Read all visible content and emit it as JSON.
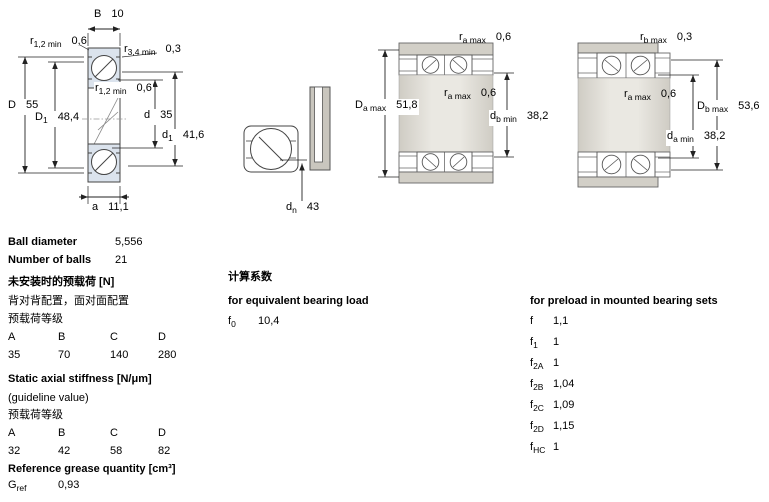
{
  "drawings": {
    "d1": {
      "B": {
        "sym": "B",
        "sub": "",
        "val": "10"
      },
      "r12_top": {
        "sym": "r",
        "sub": "1,2 min",
        "val": "0,6"
      },
      "r34_top": {
        "sym": "r",
        "sub": "3,4 min",
        "val": "0,3"
      },
      "D": {
        "sym": "D",
        "sub": "",
        "val": "55"
      },
      "D1": {
        "sym": "D",
        "sub": "1",
        "val": "48,4"
      },
      "r12_mid": {
        "sym": "r",
        "sub": "1,2 min",
        "val": "0,6"
      },
      "d": {
        "sym": "d",
        "sub": "",
        "val": "35"
      },
      "d1": {
        "sym": "d",
        "sub": "1",
        "val": "41,6"
      },
      "a": {
        "sym": "a",
        "sub": "",
        "val": "11,1"
      }
    },
    "d2": {
      "dn": {
        "sym": "d",
        "sub": "n",
        "val": "43"
      }
    },
    "d3": {
      "ra_top": {
        "sym": "r",
        "sub": "a max",
        "val": "0,6"
      },
      "Da": {
        "sym": "D",
        "sub": "a max",
        "val": "51,8"
      },
      "ra_mid": {
        "sym": "r",
        "sub": "a max",
        "val": "0,6"
      },
      "db": {
        "sym": "d",
        "sub": "b min",
        "val": "38,2"
      }
    },
    "d4": {
      "rb_top": {
        "sym": "r",
        "sub": "b max",
        "val": "0,3"
      },
      "ra_mid": {
        "sym": "r",
        "sub": "a max",
        "val": "0,6"
      },
      "Db": {
        "sym": "D",
        "sub": "b max",
        "val": "53,6"
      },
      "da": {
        "sym": "d",
        "sub": "a min",
        "val": "38,2"
      }
    }
  },
  "specs": {
    "ball_diameter_label": "Ball diameter",
    "ball_diameter_value": "5,556",
    "number_of_balls_label": "Number of balls",
    "number_of_balls_value": "21",
    "preload_title": "未安装时的预载荷 [N]",
    "preload_sub1": "背对背配置，面对面配置",
    "preload_sub2": "预载荷等级",
    "preload_headers": [
      "A",
      "B",
      "C",
      "D"
    ],
    "preload_values": [
      "35",
      "70",
      "140",
      "280"
    ],
    "stiffness_title": "Static axial stiffness [N/μm]",
    "stiffness_sub1": "(guideline value)",
    "stiffness_sub2": "预载荷等级",
    "stiffness_headers": [
      "A",
      "B",
      "C",
      "D"
    ],
    "stiffness_values": [
      "32",
      "42",
      "58",
      "82"
    ],
    "grease_title": "Reference grease quantity [cm³]",
    "grease_row": {
      "sym": "G",
      "sub": "ref",
      "val": "0,93"
    }
  },
  "calc": {
    "title_cn": "计算系数",
    "equiv_title": "for equivalent bearing load",
    "f0": {
      "sym": "f",
      "sub": "0",
      "val": "10,4"
    }
  },
  "preload_factors": {
    "title": "for preload in mounted bearing sets",
    "rows": [
      {
        "sym": "f",
        "sub": "",
        "val": "1,1"
      },
      {
        "sym": "f",
        "sub": "1",
        "val": "1"
      },
      {
        "sym": "f",
        "sub": "2A",
        "val": "1"
      },
      {
        "sym": "f",
        "sub": "2B",
        "val": "1,04"
      },
      {
        "sym": "f",
        "sub": "2C",
        "val": "1,09"
      },
      {
        "sym": "f",
        "sub": "2D",
        "val": "1,15"
      },
      {
        "sym": "f",
        "sub": "HC",
        "val": "1"
      }
    ]
  },
  "colors": {
    "bearing_fill": "#dbe3ed",
    "housing_gray": "#d2cfc7",
    "line": "#222222"
  }
}
